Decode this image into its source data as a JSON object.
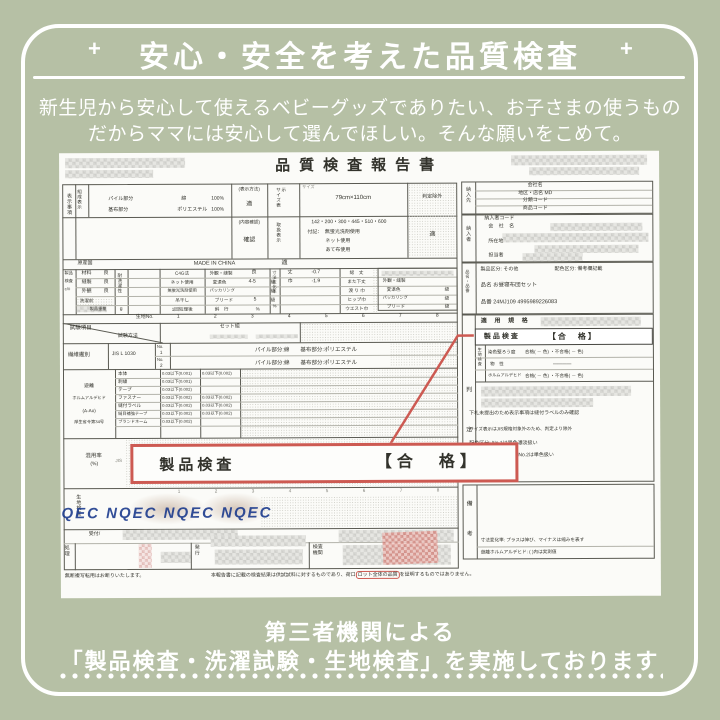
{
  "colors": {
    "background": "#b6c0a5",
    "accent_red": "#cd5a52",
    "watermark_blue": "#1c3b8d",
    "paper": "#fbfbf8"
  },
  "banner": {
    "title": "安心・安全を考えた品質検査",
    "plus": "+",
    "subtitle1": "新生児から安心して使えるベビーグッズでありたい、お子さまの使うもの",
    "subtitle2": "だからママには安心して選んでほしい。そんな願いをこめて。",
    "footer1": "第三者機関による",
    "footer2": "「製品検査・洗濯試験・生地検査」を実施しております"
  },
  "doc": {
    "title": "品質検査報告書",
    "callout": {
      "label": "製品検査",
      "result": "【合　格】"
    },
    "left": {
      "hyoji": {
        "section": "表示事項",
        "composition": "組成表示",
        "comp_rows": [
          {
            "part": "パイル部分",
            "material": "綿",
            "pct": "100%"
          },
          {
            "part": "基布部分",
            "material": "ポリエステル",
            "pct": "100%"
          }
        ],
        "method_label": "(表示方法)",
        "method_result": "適",
        "size_col": "サイズ表示",
        "size_key": "サイズ",
        "size_value": "79cm×110cm",
        "size_result": "判定除外",
        "content_label": "(内容確認)",
        "content_result": "確認",
        "care_col": "取扱表示",
        "care_codes": "142・200・300・445・510・600",
        "care_note1": "付記：　無蛍光洗剤使用",
        "care_note2": "ネット使用",
        "care_note3": "あて布使用",
        "care_result": "適",
        "origin_label": "原産国",
        "origin_value": "MADE IN CHINA",
        "origin_result": "適"
      },
      "seihin": {
        "vlabel1": "製品",
        "vlabel2": "検査",
        "vlabel3": "c/#",
        "items": [
          {
            "k": "材料",
            "v": "良"
          },
          {
            "k": "縫製",
            "v": "良"
          },
          {
            "k": "外観",
            "v": "良"
          }
        ],
        "before": "洗濯前",
        "weight": "製品重量",
        "weight_unit": "g",
        "wash_vlabel": "耐洗濯性",
        "wash_rows": [
          "C4G法",
          "ネット使用",
          "無蛍光洗剤使用",
          "吊干し",
          "1回処理後"
        ],
        "check_rows": [
          {
            "k": "外観・縫製",
            "v": "良",
            "u": ""
          },
          {
            "k": "変退色",
            "v": "4-5",
            "u": "級"
          },
          {
            "k": "パッカリング",
            "v": "",
            "u": "級"
          },
          {
            "k": "ブリード",
            "v": "5",
            "u": "級"
          },
          {
            "k": "斜　行",
            "v": "",
            "u": "%"
          }
        ],
        "dim_vlabel": "寸法変化率",
        "dim_vunit": "%",
        "dims": [
          {
            "k": "丈",
            "v": "-0.7"
          },
          {
            "k": "巾",
            "v": "-1.9"
          }
        ],
        "dim_names": [
          "総　丈",
          "また下丈",
          "渡 り 巾",
          "ヒップ巾",
          "ウエスト巾"
        ],
        "mini_rows": [
          {
            "k": "外観・縫製",
            "u": ""
          },
          {
            "k": "変退色",
            "u": "級"
          },
          {
            "k": "パッカリング",
            "u": "級"
          },
          {
            "k": "ブリード",
            "u": "級"
          }
        ]
      },
      "kiji_no": {
        "label": "生地No.",
        "numbers": [
          "1",
          "2",
          "3",
          "4",
          "5",
          "6",
          "7",
          "8"
        ]
      },
      "shiken": {
        "item": "試験項目",
        "method": "試験方法",
        "set": "セット組"
      },
      "seni": {
        "label": "繊維鑑別",
        "std": "JIS L 1030",
        "no_label": "No.",
        "no1": "1",
        "no2": "2",
        "result": "パイル部分:綿　　基布部分:ポリエステル"
      },
      "form": {
        "l1": "遊離",
        "l2": "ホルムアルデヒド",
        "l3": "(A-Ao)",
        "l4": "厚生省令第34号",
        "rows": [
          {
            "item": "本体",
            "v1": "0.03以下(0.001)",
            "v2": "0.03以下(0.002)"
          },
          {
            "item": "刺繍",
            "v1": "0.03以下(0.001)",
            "v2": ""
          },
          {
            "item": "テープ",
            "v1": "0.03以下(0.002)",
            "v2": ""
          },
          {
            "item": "ファスナー",
            "v1": "0.03以下(0.002)",
            "v2": "0.03以下(0.002)"
          },
          {
            "item": "縫付ラベル",
            "v1": "0.03以下(0.002)",
            "v2": "0.03以下(0.002)"
          },
          {
            "item": "縫目補強テープ",
            "v1": "0.03以下(0.002)",
            "v2": "0.03以下(0.002)"
          },
          {
            "item": "ブランドネーム",
            "v1": "0.03以下(0.002)",
            "v2": ""
          }
        ]
      },
      "konyo": {
        "label": "混用率",
        "pct": "(%)",
        "std": "JIS"
      },
      "kiji_kensa": {
        "label": "生地検査",
        "watermark": "NQEC NQEC NQEC NQEC"
      },
      "bottom": {
        "reception": "受付/",
        "processing": "処理",
        "issue": "発行",
        "agency": "検査機関"
      },
      "note_left": "無断複写転用はお断りいたします。",
      "note_right_a": "本報告書に記載の検査結果は供試試料に対するものであり、荷口",
      "note_right_b": "ロット全体の品質",
      "note_right_c": "を証明するものではありません。"
    },
    "right": {
      "supplier_to": {
        "label": "納入先",
        "rows": [
          "会社名",
          "地区・店名 MD",
          "分類コード",
          "商品コード"
        ]
      },
      "supplier": {
        "label": "納入者",
        "code": "納入者コード",
        "company": "会 社 名",
        "address": "所在地",
        "person": "担当者"
      },
      "item": {
        "label": "品名・品番",
        "kubun": "製品区分: その他",
        "haishoku": "配色区分: 備考欄記載",
        "name": "品名 お昼寝布団セット",
        "number": "品番 24MJ109 4995989226083"
      },
      "hantei": {
        "label": "判定",
        "header": "適 用 規 格",
        "product": "製品検査",
        "result": "【合　格】",
        "kiji": "生地検査",
        "rows": [
          {
            "k": "染色堅ろう度",
            "v": "合格( － 色) ・不合格( － 色)"
          },
          {
            "k": "物　性",
            "v": "――――"
          },
          {
            "k": "ホルムアルデヒド",
            "v": "合格( － 色) ・不合格( － 色)"
          }
        ],
        "notes": [
          "下札未提出のため表示事項は縫付ラベルのみ確認",
          "サイズ表示はJIS規格対象外のため、判定より除外",
          "配色区分: No.1は異色濃淡扱い",
          "No.2は単色扱い"
        ]
      },
      "biko": {
        "label": "備考",
        "note1": "寸法変化率: プラスは伸び、マイナスは縮みを表す",
        "note2": "遊離ホルムアルデヒド: ( )内は実測値"
      }
    }
  }
}
